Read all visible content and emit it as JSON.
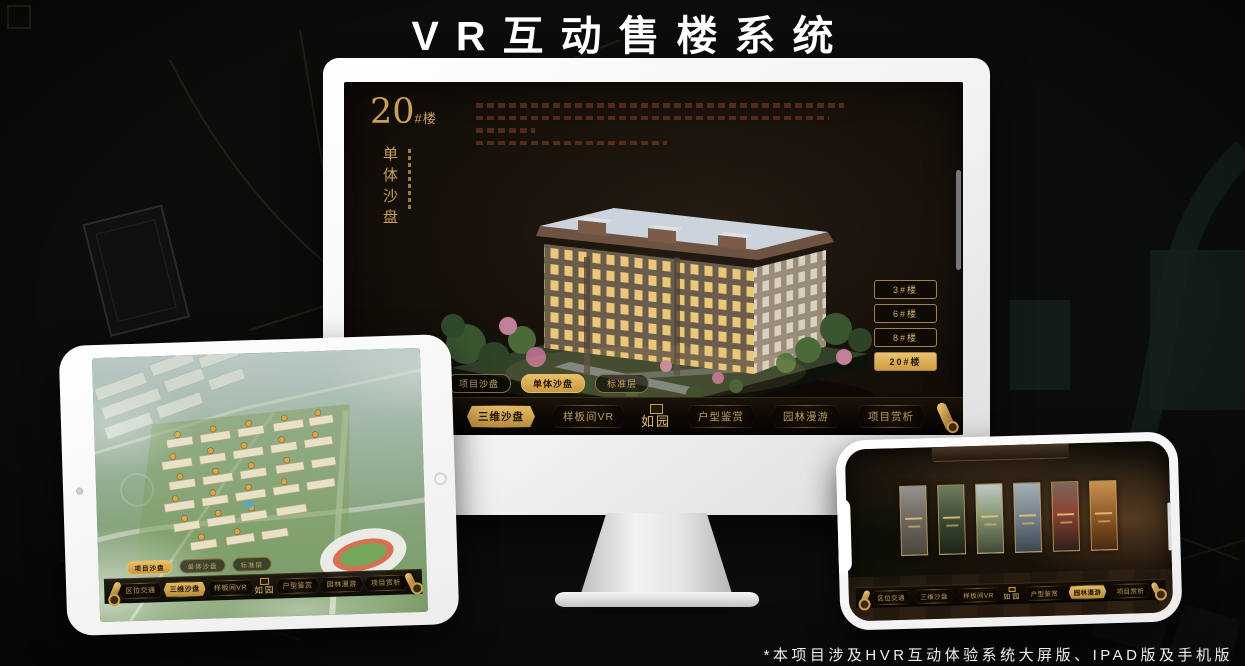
{
  "page": {
    "title": "VR互动售楼系统",
    "footnote": "*本项目涉及HVR互动体验系统大屏版、IPAD版及手机版"
  },
  "brand": {
    "logo": "如园"
  },
  "nav_items": [
    {
      "label": "区位交通"
    },
    {
      "label": "三维沙盘"
    },
    {
      "label": "样板间VR"
    },
    {
      "label": "户型鉴赏"
    },
    {
      "label": "园林漫游"
    },
    {
      "label": "项目赏析"
    }
  ],
  "subtabs": [
    {
      "label": "项目沙盘"
    },
    {
      "label": "单体沙盘"
    },
    {
      "label": "标准层"
    }
  ],
  "monitor": {
    "block_number": "20",
    "block_suffix": "#楼",
    "vertical_title": "单体沙盘",
    "active_subtab": "单体沙盘",
    "active_nav": "三维沙盘",
    "active_building": "20#楼",
    "building_buttons": [
      {
        "label": "3#楼",
        "active": false
      },
      {
        "label": "6#楼",
        "active": false
      },
      {
        "label": "8#楼",
        "active": false
      },
      {
        "label": "20#楼",
        "active": true
      }
    ]
  },
  "ipad": {
    "active_subtab": "项目沙盘",
    "active_nav": "三维沙盘"
  },
  "phone": {
    "active_nav": "园林漫游",
    "gallery_panel_count": 6
  },
  "colors": {
    "gold": "#C9A057",
    "gold_bright": "#E7C173",
    "active_tab_bg": "#DCAF5C",
    "active_tab_text": "#241806",
    "screen_bg": "#171209",
    "page_bg": "#0A0D0A",
    "device_white": "#FFFFFF"
  }
}
